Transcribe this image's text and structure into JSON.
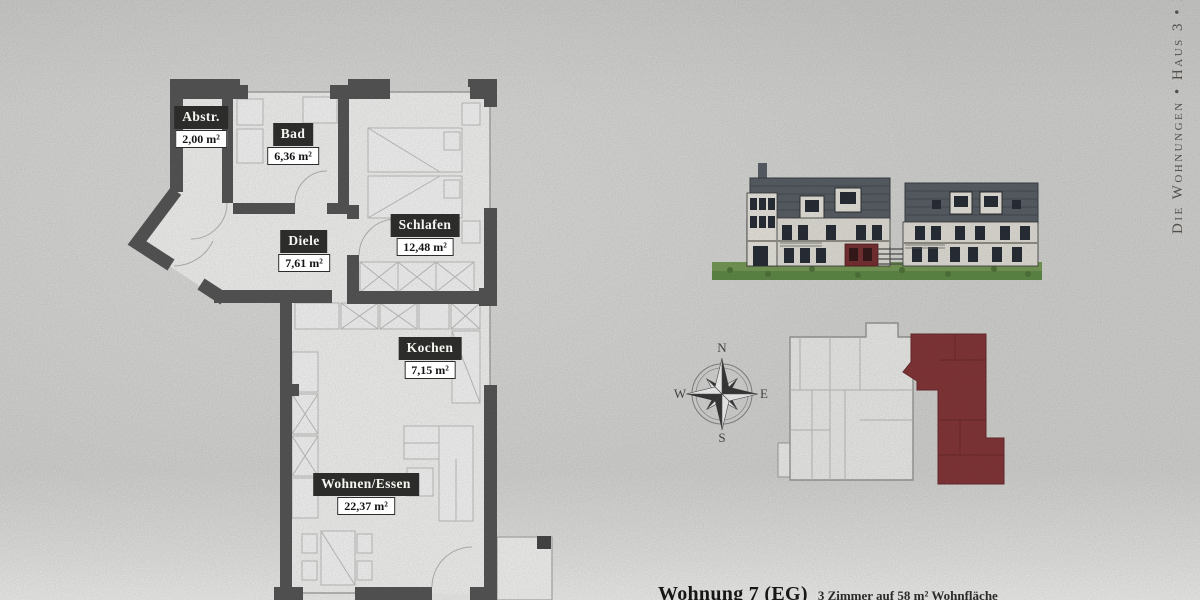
{
  "side_text": "Die Wohnungen • Haus 3 • E",
  "footer": {
    "title": "Wohnung 7 (EG)",
    "subtitle": "3 Zimmer auf 58 m² Wohnfläche"
  },
  "floorplan": {
    "rooms": [
      {
        "name": "Abstr.",
        "area": "2,00 m²"
      },
      {
        "name": "Bad",
        "area": "6,36 m²"
      },
      {
        "name": "Schlafen",
        "area": "12,48 m²"
      },
      {
        "name": "Diele",
        "area": "7,61 m²"
      },
      {
        "name": "Kochen",
        "area": "7,15 m²"
      },
      {
        "name": "Wohnen/Essen",
        "area": "22,37 m²"
      }
    ]
  },
  "compass": {
    "north": "N",
    "east": "E",
    "south": "S",
    "west": "W"
  },
  "colors": {
    "wall": "#5a5a5a",
    "label_bg": "#2c2c2a",
    "highlight_red": "#8a393b",
    "roof_gray": "#5d646b",
    "grass_green": "#6f9c55",
    "background": "#dcdcda"
  }
}
